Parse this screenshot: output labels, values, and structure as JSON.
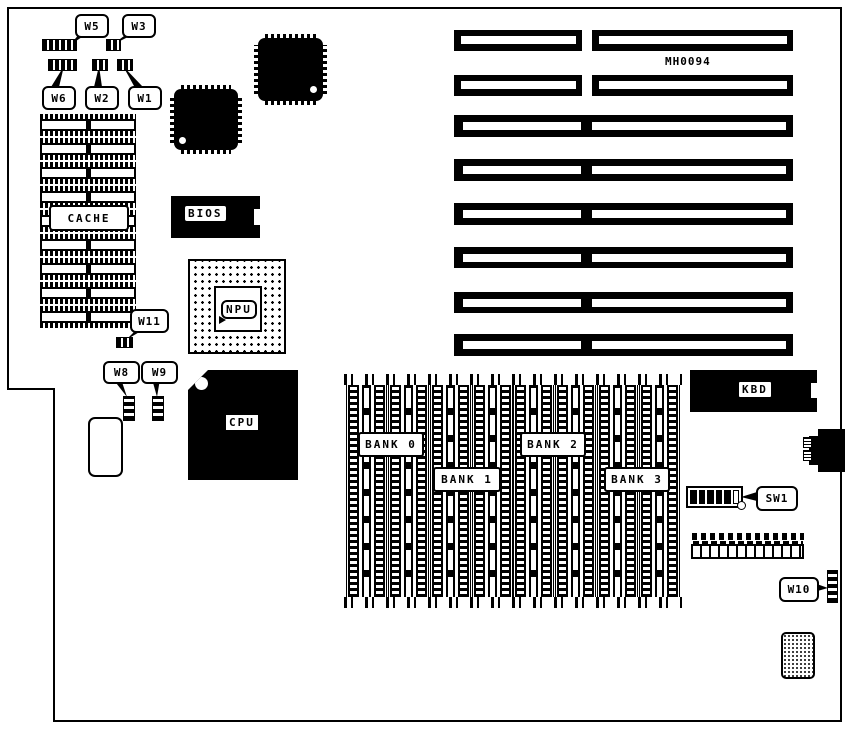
{
  "board": {
    "part_number": "MH0094",
    "line_color": "#000000",
    "bg_color": "#ffffff"
  },
  "labels": {
    "w1": "W1",
    "w2": "W2",
    "w3": "W3",
    "w5": "W5",
    "w6": "W6",
    "w8": "W8",
    "w9": "W9",
    "w10": "W10",
    "w11": "W11",
    "sw1": "SW1",
    "cache": "CACHE",
    "bios": "BIOS",
    "npu": "NPU",
    "cpu": "CPU",
    "kbd": "KBD",
    "bank0": "BANK 0",
    "bank1": "BANK 1",
    "bank2": "BANK 2",
    "bank3": "BANK 3"
  },
  "counts": {
    "cache_rows": 9,
    "simm_columns": 8,
    "isa_slots": 8,
    "sw1_positions": 6,
    "sw1_on_positions": 5
  }
}
